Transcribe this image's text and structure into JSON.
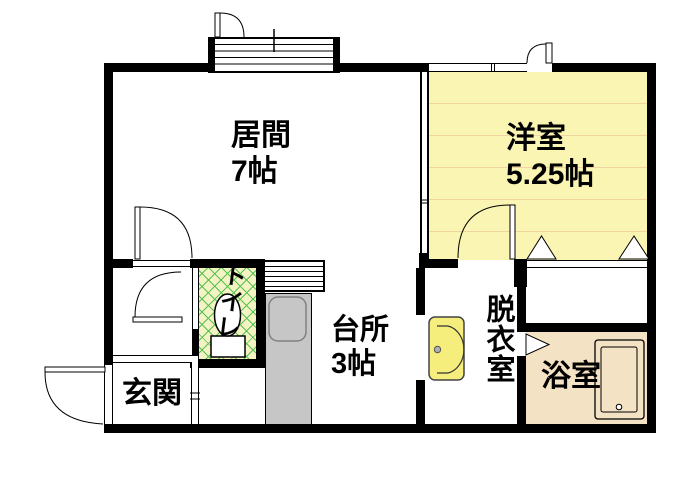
{
  "floorplan": {
    "rooms": {
      "living": {
        "name": "居間",
        "size": "7帖"
      },
      "western": {
        "name": "洋室",
        "size": "5.25帖"
      },
      "kitchen": {
        "name": "台所",
        "size": "3帖"
      },
      "toilet": {
        "name": "トイレ"
      },
      "dressing": {
        "name": "脱衣室"
      },
      "bath": {
        "name": "浴室"
      },
      "entrance": {
        "name": "玄関"
      }
    },
    "colors": {
      "plan_bg": "#ffffff",
      "wall": "#000000",
      "western_bg": "#faf5b2",
      "western_stripe": "#f0d5a0",
      "toilet_bg": "#f3f3c4",
      "toilet_hatch": "#55c34f",
      "bath_bg": "#f3e2c3",
      "counter": "#c6c6c6",
      "basin": "#f6ee7c"
    }
  }
}
